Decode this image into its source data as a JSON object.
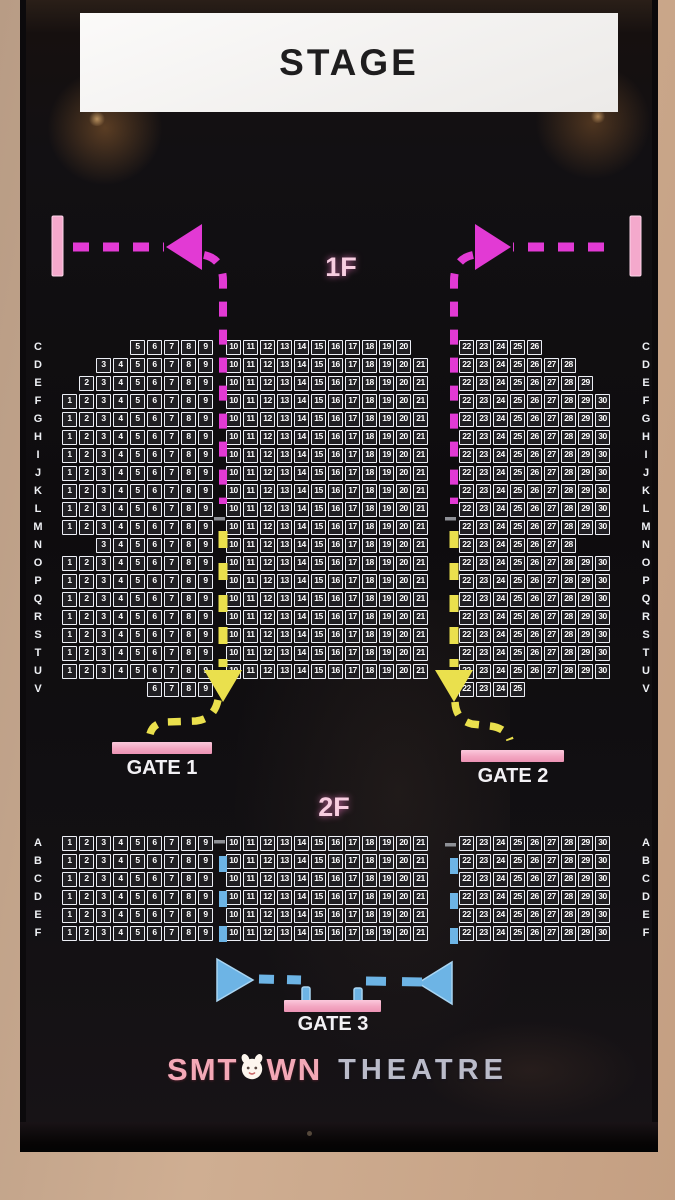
{
  "stage_label": "STAGE",
  "floors": [
    {
      "label": "1F",
      "rows": [
        {
          "label": "C",
          "left": [
            5,
            9
          ],
          "center": [
            10,
            20
          ],
          "right": [
            22,
            26
          ]
        },
        {
          "label": "D",
          "left": [
            3,
            9
          ],
          "center": [
            10,
            21
          ],
          "right": [
            22,
            28
          ]
        },
        {
          "label": "E",
          "left": [
            2,
            9
          ],
          "center": [
            10,
            21
          ],
          "right": [
            22,
            29
          ]
        },
        {
          "label": "F",
          "left": [
            1,
            9
          ],
          "center": [
            10,
            21
          ],
          "right": [
            22,
            30
          ]
        },
        {
          "label": "G",
          "left": [
            1,
            9
          ],
          "center": [
            10,
            21
          ],
          "right": [
            22,
            30
          ]
        },
        {
          "label": "H",
          "left": [
            1,
            9
          ],
          "center": [
            10,
            21
          ],
          "right": [
            22,
            30
          ]
        },
        {
          "label": "I",
          "left": [
            1,
            9
          ],
          "center": [
            10,
            21
          ],
          "right": [
            22,
            30
          ]
        },
        {
          "label": "J",
          "left": [
            1,
            9
          ],
          "center": [
            10,
            21
          ],
          "right": [
            22,
            30
          ]
        },
        {
          "label": "K",
          "left": [
            1,
            9
          ],
          "center": [
            10,
            21
          ],
          "right": [
            22,
            30
          ]
        },
        {
          "label": "L",
          "left": [
            1,
            9
          ],
          "center": [
            10,
            21
          ],
          "right": [
            22,
            30
          ]
        },
        {
          "label": "M",
          "left": [
            1,
            9
          ],
          "center": [
            10,
            21
          ],
          "right": [
            22,
            30
          ]
        },
        {
          "label": "N",
          "left": [
            3,
            9
          ],
          "center": [
            10,
            21
          ],
          "right": [
            22,
            28
          ]
        },
        {
          "label": "O",
          "left": [
            1,
            9
          ],
          "center": [
            10,
            21
          ],
          "right": [
            22,
            30
          ]
        },
        {
          "label": "P",
          "left": [
            1,
            9
          ],
          "center": [
            10,
            21
          ],
          "right": [
            22,
            30
          ]
        },
        {
          "label": "Q",
          "left": [
            1,
            9
          ],
          "center": [
            10,
            21
          ],
          "right": [
            22,
            30
          ]
        },
        {
          "label": "R",
          "left": [
            1,
            9
          ],
          "center": [
            10,
            21
          ],
          "right": [
            22,
            30
          ]
        },
        {
          "label": "S",
          "left": [
            1,
            9
          ],
          "center": [
            10,
            21
          ],
          "right": [
            22,
            30
          ]
        },
        {
          "label": "T",
          "left": [
            1,
            9
          ],
          "center": [
            10,
            21
          ],
          "right": [
            22,
            30
          ]
        },
        {
          "label": "U",
          "left": [
            1,
            9
          ],
          "center": [
            10,
            21
          ],
          "right": [
            22,
            30
          ]
        },
        {
          "label": "V",
          "left": [
            6,
            9
          ],
          "center": null,
          "right": [
            22,
            25
          ]
        }
      ]
    },
    {
      "label": "2F",
      "rows": [
        {
          "label": "A",
          "left": [
            1,
            9
          ],
          "center": [
            10,
            21
          ],
          "right": [
            22,
            30
          ]
        },
        {
          "label": "B",
          "left": [
            1,
            9
          ],
          "center": [
            10,
            21
          ],
          "right": [
            22,
            30
          ]
        },
        {
          "label": "C",
          "left": [
            1,
            9
          ],
          "center": [
            10,
            21
          ],
          "right": [
            22,
            30
          ]
        },
        {
          "label": "D",
          "left": [
            1,
            9
          ],
          "center": [
            10,
            21
          ],
          "right": [
            22,
            30
          ]
        },
        {
          "label": "E",
          "left": [
            1,
            9
          ],
          "center": [
            10,
            21
          ],
          "right": [
            22,
            30
          ]
        },
        {
          "label": "F",
          "left": [
            1,
            9
          ],
          "center": [
            10,
            21
          ],
          "right": [
            22,
            30
          ]
        }
      ]
    }
  ],
  "gates": [
    {
      "label": "GATE 1"
    },
    {
      "label": "GATE 2"
    },
    {
      "label": "GATE 3"
    }
  ],
  "brand": {
    "part1": "SMT",
    "part2": "WN",
    "part3": "THEATRE"
  },
  "colors": {
    "magenta": "#e23ad4",
    "pink_bar": "#f4a9cc",
    "yellow": "#eae04d",
    "blue": "#6db4e5",
    "gate_pink": "#f3a6c1",
    "brand_pink": "#f3a8b6",
    "brand_silver": "#babbc9",
    "seat_border": "#edeff6",
    "floor_label_pink": "#f7cde0"
  }
}
